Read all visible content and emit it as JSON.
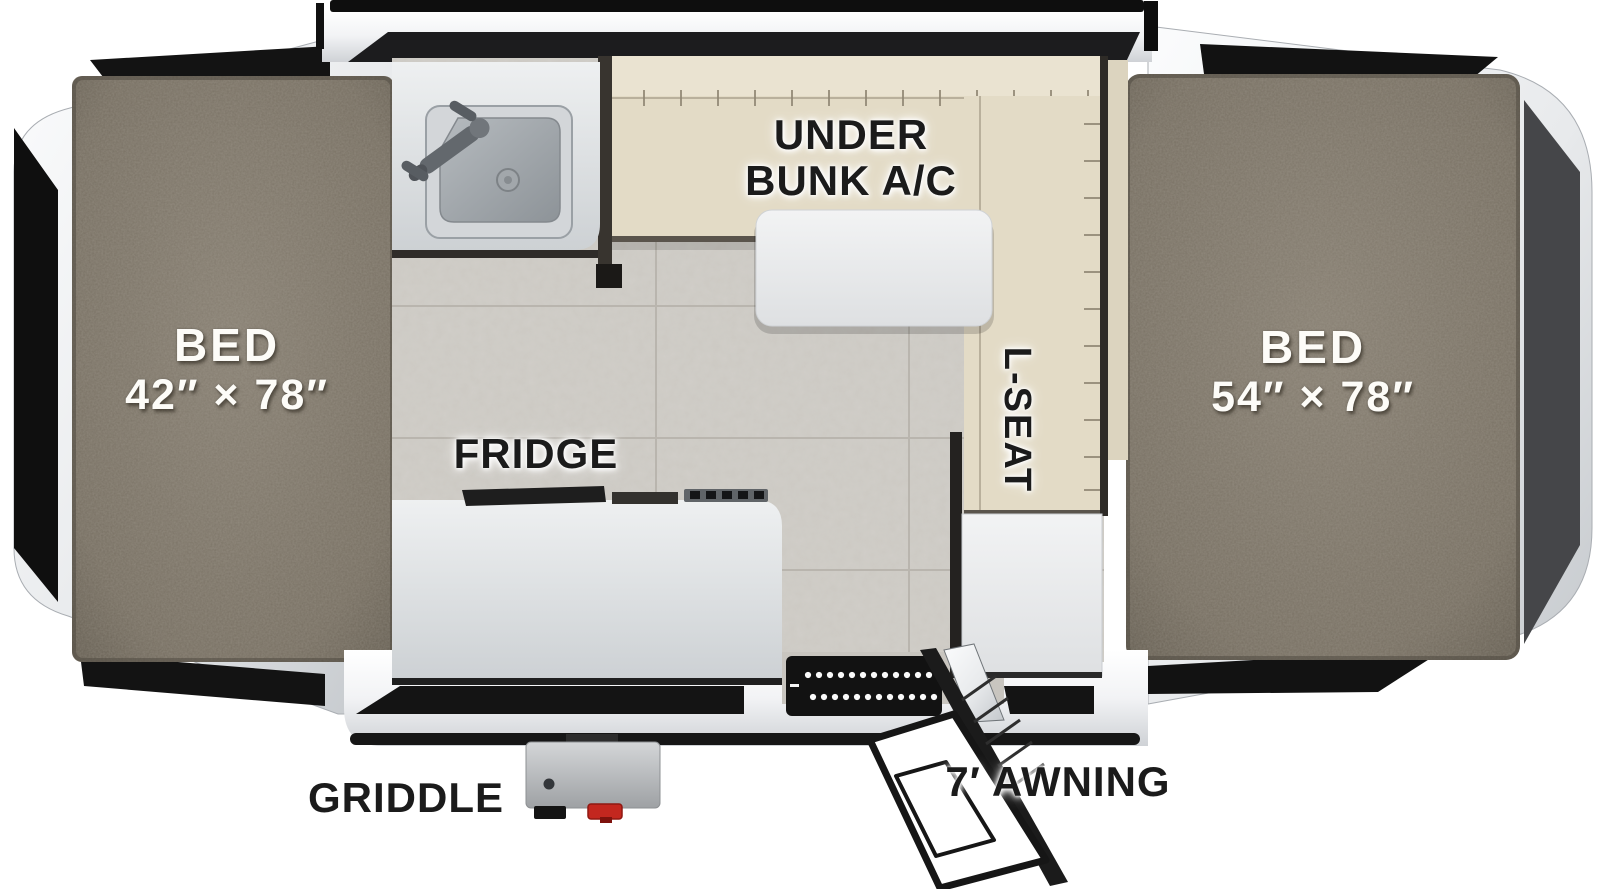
{
  "labels": {
    "bed_left_title": "BED",
    "bed_left_dims": "42″ × 78″",
    "bed_right_title": "BED",
    "bed_right_dims": "54″ × 78″",
    "under_bunk_line1": "UNDER",
    "under_bunk_line2": "BUNK A/C",
    "fridge": "FRIDGE",
    "l_seat": "L-SEAT",
    "griddle": "GRIDDLE",
    "awning": "7′ AWNING"
  },
  "colors": {
    "background": "#ffffff",
    "carpet": "#7c7567",
    "cushion": "#e3dbc6",
    "tile": "#ccc9c3",
    "counter": "#dfe2e4",
    "accent_black": "#141414",
    "label_dark": "#1b1b1b",
    "label_light": "#fdfcf9",
    "valve_red": "#c3271f"
  }
}
